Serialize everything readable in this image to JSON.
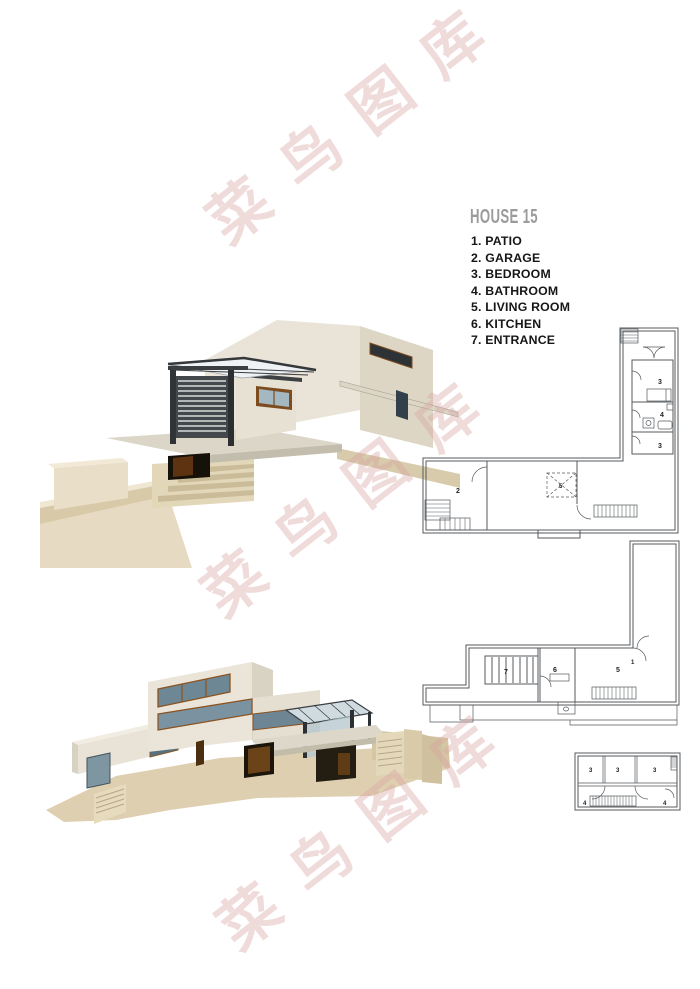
{
  "header": {
    "title": "HOUSE 15",
    "title_color": "#9b9b9d"
  },
  "legend": {
    "items": [
      "1. PATIO",
      "2. GARAGE",
      "3. BEDROOM",
      "4. BATHROOM",
      "5. LIVING ROOM",
      "6. KITCHEN",
      "7. ENTRANCE"
    ]
  },
  "watermark": {
    "text": "菜鸟图库",
    "color": "#d9a3a3"
  },
  "plans": {
    "plan1": {
      "labels": [
        "3",
        "4",
        "3",
        "2",
        "5"
      ]
    },
    "plan2": {
      "labels": [
        "1",
        "7",
        "6",
        "5"
      ]
    },
    "plan3": {
      "labels": [
        "3",
        "3",
        "3",
        "4",
        "4"
      ]
    }
  },
  "palette": {
    "page_bg": "#ffffff",
    "legend_text": "#161616",
    "plan_line": "#55595d",
    "render_cream": "#eae5d8",
    "render_cream_shade": "#d9d3c3",
    "render_terrain": "#decfb0",
    "render_dark_frame": "#3a3e41",
    "render_glass": "#7b93a0",
    "render_wood": "#6b4318"
  }
}
